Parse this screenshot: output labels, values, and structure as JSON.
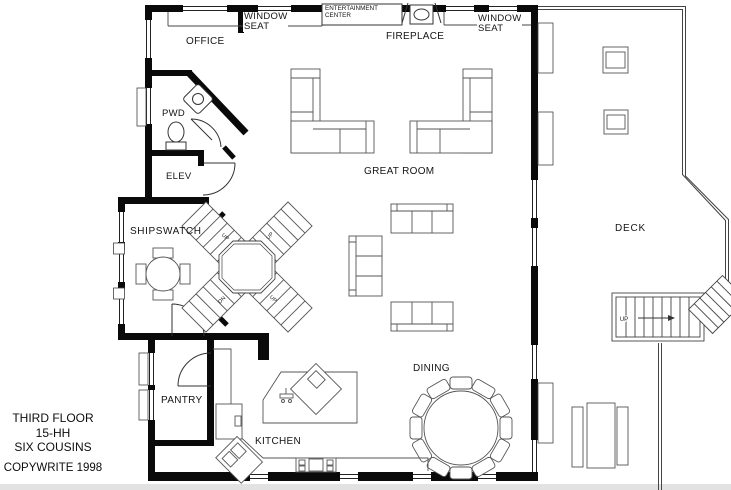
{
  "title_block": {
    "floor": "THIRD FLOOR",
    "plan_number": "15-HH",
    "plan_name": "SIX COUSINS",
    "copyright": "COPYWRITE 1998"
  },
  "labels": {
    "office": "OFFICE",
    "window_seat_left_1": "WINDOW",
    "window_seat_left_2": "SEAT",
    "entertainment_center_1": "ENTERTAINMENT",
    "entertainment_center_2": "CENTER",
    "fireplace": "FIREPLACE",
    "window_seat_right_1": "WINDOW",
    "window_seat_right_2": "SEAT",
    "pwd": "PWD",
    "elev": "ELEV",
    "shipswatch": "SHIPSWATCH",
    "great_room": "GREAT ROOM",
    "deck": "DECK",
    "dining": "DINING",
    "kitchen": "KITCHEN",
    "pantry": "PANTRY"
  },
  "stairs": {
    "x_nw": "UP",
    "x_ne": "UP",
    "x_sw": "DN",
    "x_se": "UP",
    "deck_up": "UP"
  }
}
